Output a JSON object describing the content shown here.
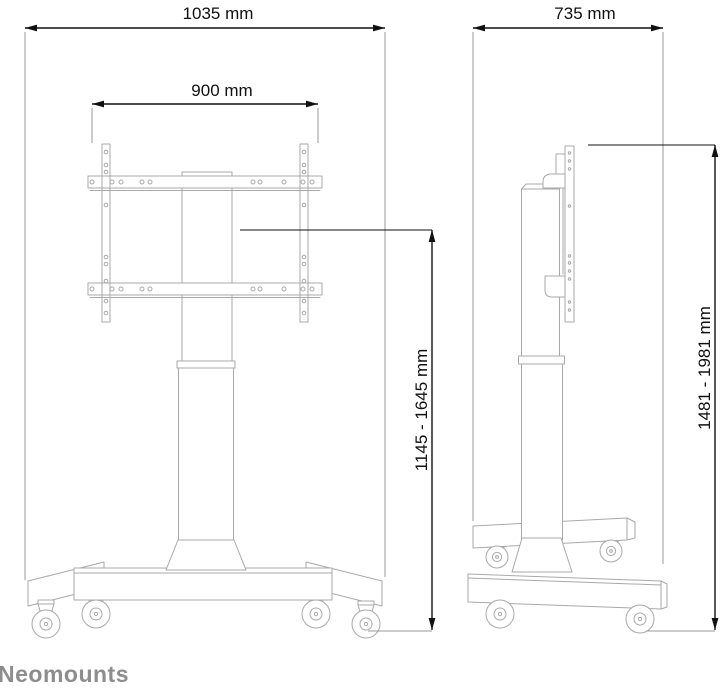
{
  "brand": "Neomounts",
  "colors": {
    "background": "#ffffff",
    "dimension_line": "#111111",
    "product_outline": "#a9a9a9",
    "extension_line": "#999999",
    "brand_text": "#8d8d8d"
  },
  "front_view": {
    "dim_overall_width": "1035 mm",
    "dim_vesa_width": "900 mm",
    "dim_screen_center_height": "1145 - 1645 mm"
  },
  "side_view": {
    "dim_depth": "735 mm",
    "dim_overall_height": "1481 - 1981 mm"
  }
}
